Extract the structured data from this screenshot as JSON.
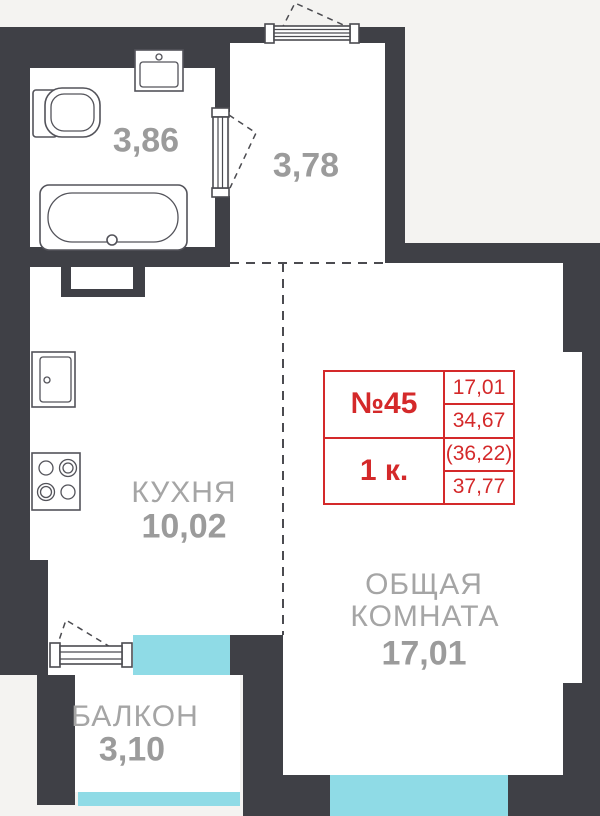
{
  "info_card": {
    "unit": "№45",
    "rooms": "1 к.",
    "areas": [
      "17,01",
      "34,67",
      "(36,22)",
      "37,77"
    ]
  },
  "rooms": {
    "bathroom": {
      "area": "3,86"
    },
    "hall": {
      "area": "3,78"
    },
    "kitchen": {
      "name": "КУХНЯ",
      "area": "10,02"
    },
    "living": {
      "name_line1": "ОБЩАЯ",
      "name_line2": "КОМНАТА",
      "area": "17,01"
    },
    "balcony": {
      "name": "БАЛКОН",
      "area": "3,10"
    }
  },
  "colors": {
    "wall": "#3f4046",
    "background": "#f4f3f1",
    "floor": "#ffffff",
    "glazing": "#8fdbe6",
    "accent_red": "#d4292a",
    "label_gray": "#a5a5a5"
  },
  "icons": {
    "fixtures": [
      "toilet-icon",
      "washbasin-icon",
      "bathtub-icon",
      "kitchen-sink-icon",
      "stove-icon",
      "vent-shaft-icon",
      "door-icon",
      "window-icon"
    ]
  }
}
